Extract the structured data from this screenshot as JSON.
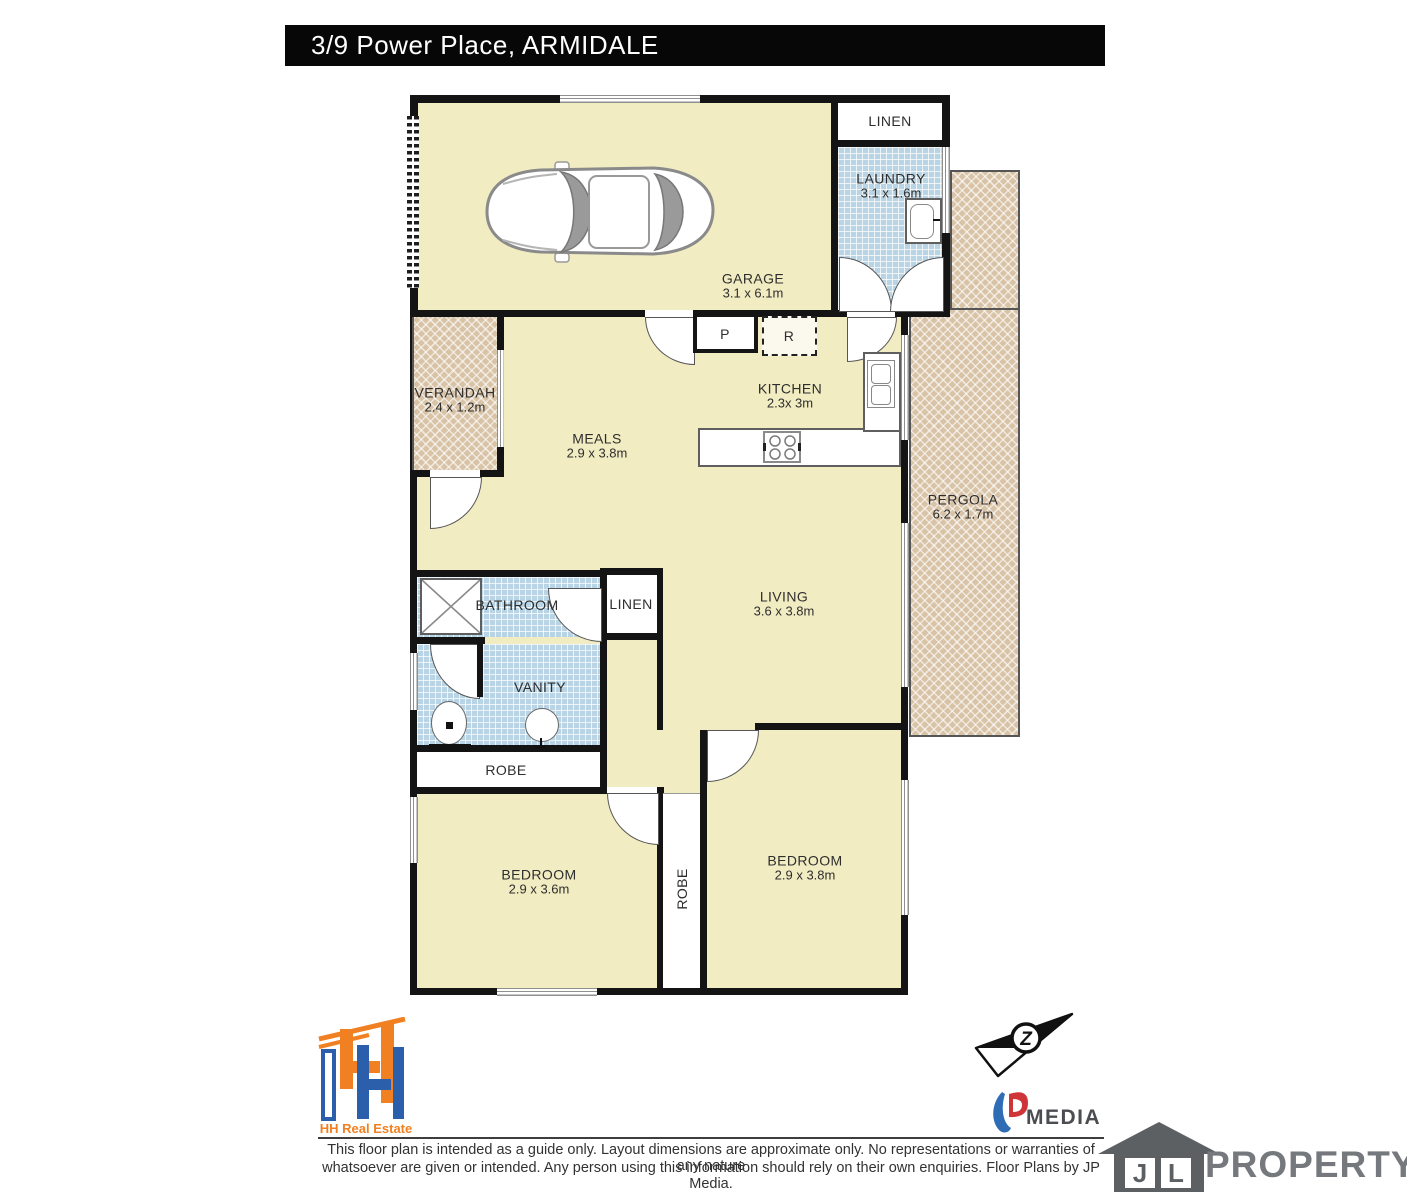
{
  "title": "3/9 Power Place, ARMIDALE",
  "rooms": {
    "garage": {
      "name": "GARAGE",
      "dims": "3.1 x 6.1m"
    },
    "linen_top": {
      "name": "LINEN"
    },
    "laundry": {
      "name": "LAUNDRY",
      "dims": "3.1 x 1.6m"
    },
    "verandah": {
      "name": "VERANDAH",
      "dims": "2.4 x 1.2m"
    },
    "meals": {
      "name": "MEALS",
      "dims": "2.9 x 3.8m"
    },
    "kitchen": {
      "name": "KITCHEN",
      "dims": "2.3x 3m"
    },
    "pergola": {
      "name": "PERGOLA",
      "dims": "6.2 x 1.7m"
    },
    "living": {
      "name": "LIVING",
      "dims": "3.6 x 3.8m"
    },
    "bathroom": {
      "name": "BATHROOM"
    },
    "linen_hall": {
      "name": "LINEN"
    },
    "vanity": {
      "name": "VANITY"
    },
    "robe_hall": {
      "name": "ROBE"
    },
    "bedroom_left": {
      "name": "BEDROOM",
      "dims": "2.9 x 3.6m"
    },
    "robe_between": {
      "name": "ROBE"
    },
    "bedroom_right": {
      "name": "BEDROOM",
      "dims": "2.9 x 3.8m"
    }
  },
  "fixtures": {
    "pantry": "P",
    "refrigerator": "R"
  },
  "footer": {
    "hh_real_estate": "HH Real Estate",
    "media_brand": "MEDIA",
    "north_letter": "Z",
    "jl_j": "J",
    "jl_l": "L",
    "jl_property": "PROPERTY",
    "disclaimer1": "This floor plan is intended as a guide only. Layout dimensions are approximate only. No representations or warranties of any nature",
    "disclaimer2": "whatsoever are given or intended. Any person using this information should rely on their own enquiries. Floor Plans by JP Media."
  },
  "colors": {
    "floor": "#f1ecc2",
    "wet_area_tile": "#b9d4e4",
    "outdoor_hatch": "#d9c3a7",
    "wall": "#141414",
    "brand_orange": "#f08021",
    "brand_blue": "#2b5eab",
    "brand_red": "#cf3438",
    "logo_gray": "#75787c"
  }
}
